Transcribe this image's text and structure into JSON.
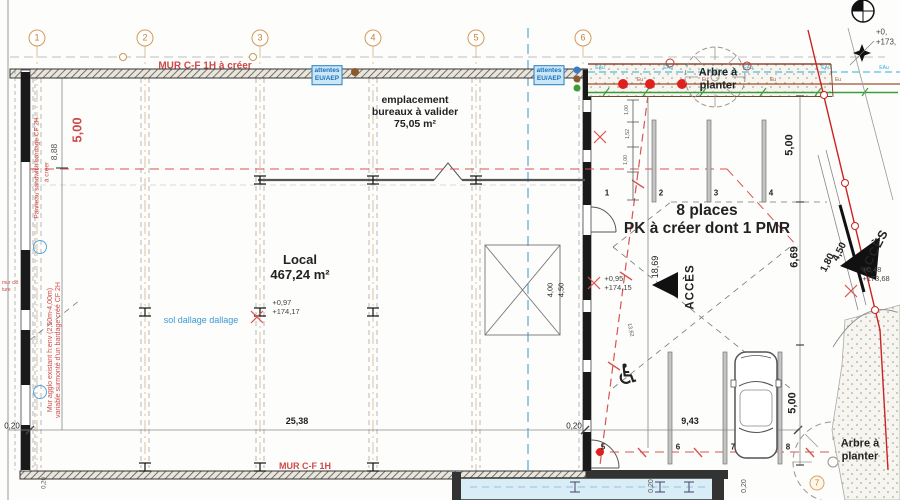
{
  "plan": {
    "walls": {
      "top": "MUR C-F 1H à créer",
      "bottom": "MUR C-F 1H"
    },
    "grid": [
      "1",
      "2",
      "3",
      "4",
      "5",
      "6"
    ],
    "attentes": {
      "l1": "attentes",
      "l2": "EU/AEP"
    },
    "bureaux": {
      "l1": "emplacement",
      "l2": "bureaux à valider",
      "l3": "75,05 m²"
    },
    "local": {
      "name": "Local",
      "area": "467,24 m²"
    },
    "parking": {
      "l1": "8 places",
      "l2": "PK à créer dont 1 PMR"
    },
    "tree": {
      "l1": "Arbre à",
      "l2": "planter"
    },
    "access": "ACCÈS",
    "sol": "sol dallage dallage",
    "stalls_top": [
      "1",
      "2",
      "3",
      "4"
    ],
    "stalls_bottom": [
      "5",
      "6",
      "7",
      "8"
    ],
    "levels": {
      "local": {
        "rel": "+0,97",
        "abs": "+174,17"
      },
      "parking": {
        "rel": "+0,95",
        "abs": "+174,15"
      },
      "access": {
        "rel": "+0,48",
        "abs": "+173,68"
      },
      "corner": {
        "rel": "+0,",
        "abs": "+173,"
      }
    },
    "dims": {
      "h500": "5,00",
      "h888": "8,88",
      "w2538": "25,38",
      "w943": "9,43",
      "t020a": "0,20",
      "t020b": "0,20",
      "t020c": "0,20",
      "t020d": "0,20",
      "v400": "4,00",
      "v450": "4,50",
      "v1869": "18,69",
      "v669": "6,69",
      "v500top": "5,00",
      "v500bot": "5,00",
      "r450": "4,50",
      "r180": "1,80",
      "r1362": "13,62",
      "s100a": "1,00",
      "s152": "1,52",
      "s100b": "1,00"
    },
    "notes": {
      "panel": "Panneau sandwich bardage CF 2H",
      "a_creer": "à créer",
      "mur1": "Mur agglo existant h:env (2,50m-4,00m)",
      "mur2": "variable surmonté d'un bardage créé CF 2H",
      "fence1": "mur clô",
      "fence2": "ture"
    },
    "utilities": {
      "water": "EAu",
      "sewer": "Eu"
    },
    "markers": {
      "circled7": "7",
      "wheelchair": "♿"
    }
  }
}
